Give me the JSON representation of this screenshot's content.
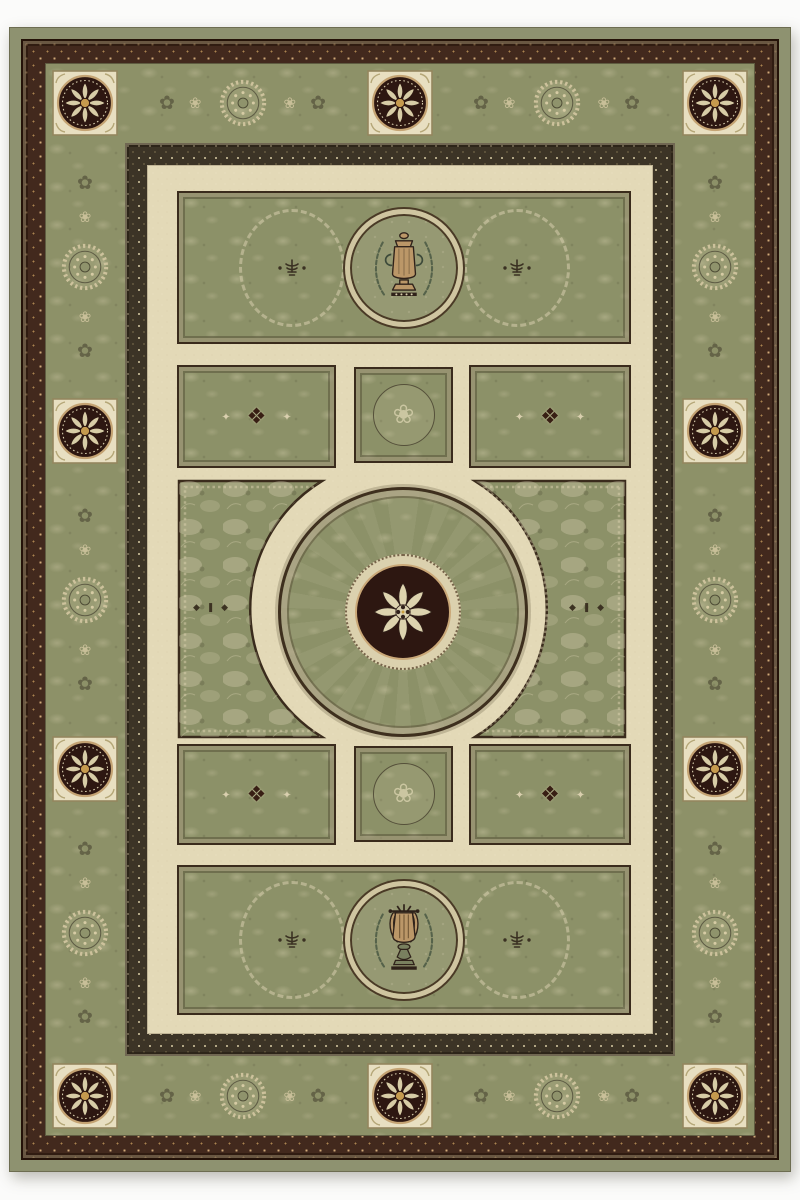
{
  "scene": {
    "description": "Product photograph of a traditional Aubusson-style rectangular area rug in sage green and cream, portrait orientation, centered on a plain white background",
    "orientation": "portrait"
  },
  "palette": {
    "photo_background": "#fbfbfa",
    "sage_green": "#8d9168",
    "field_cream": "#e3d9b7",
    "square_cream": "#e8dfc1",
    "medallion_maroon": "#2d1711",
    "accent_tan": "#c4a373",
    "outline_dark": "#3a2b1c",
    "center_gold": "#c59a4e"
  },
  "glyphs": {
    "diamond": "❖",
    "spark": "✦",
    "floret": "❀",
    "spray": "✿",
    "edge_motif": "◆ ❚ ◆"
  },
  "motifs": {
    "top_medallion": "urn in laurel wreath",
    "bottom_medallion": "lyre in laurel wreath",
    "center_medallion": "eight-petal rosette on maroon disc",
    "border_rosette_count": 10,
    "border_wreath_count": 10
  }
}
